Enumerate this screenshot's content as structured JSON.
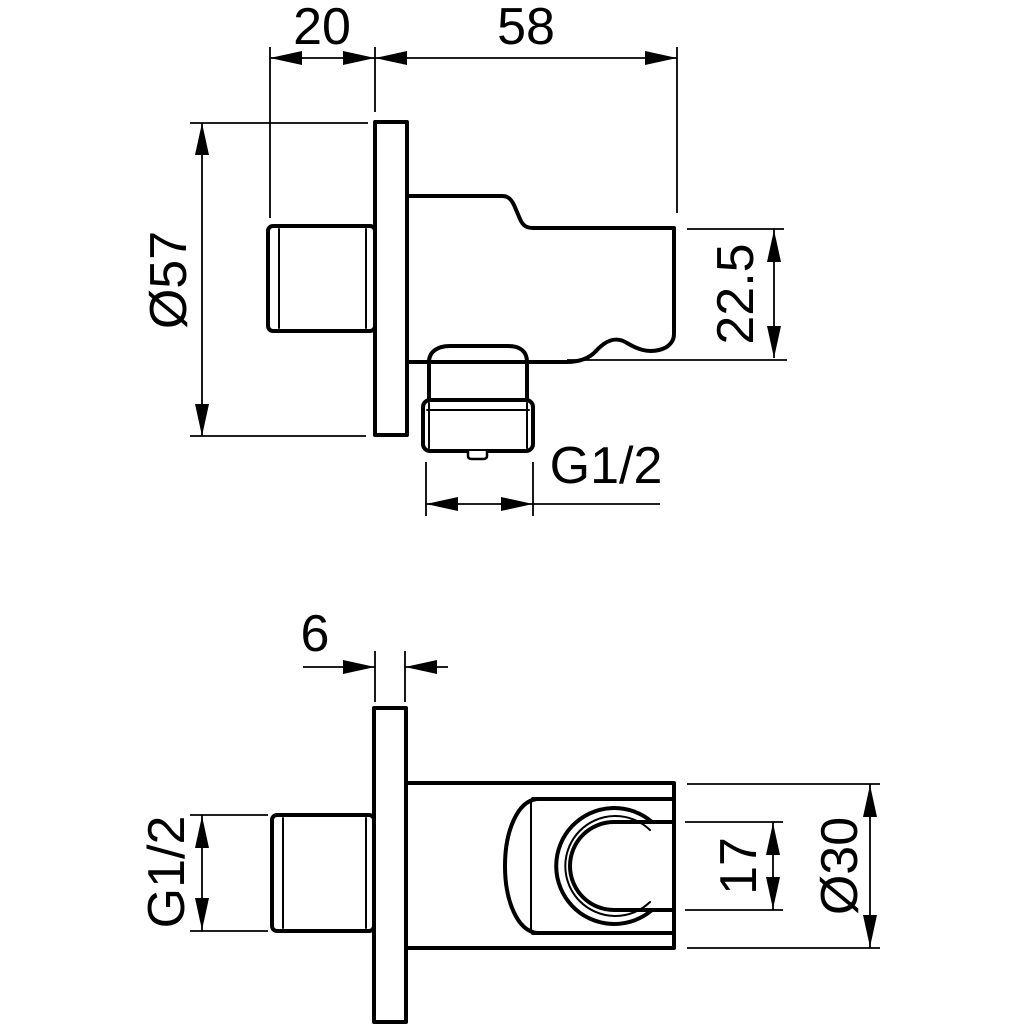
{
  "drawing": {
    "type": "technical-dimension-drawing",
    "subject": "wall-mounted shower handset holder with hose outlet elbow, two orthographic views",
    "colors": {
      "line": "#000000",
      "background": "#ffffff"
    },
    "views": {
      "top": {
        "name": "side-elevation-view"
      },
      "bottom": {
        "name": "plan-view"
      }
    },
    "dimensions": {
      "thread_to_plate": {
        "label": "20"
      },
      "body_depth": {
        "label": "58"
      },
      "plate_diameter": {
        "label": "Ø57"
      },
      "outlet_height": {
        "label": "22.5"
      },
      "outlet_thread": {
        "label": "G1/2"
      },
      "plate_thickness": {
        "label": "6"
      },
      "inlet_thread": {
        "label": "G1/2"
      },
      "cradle_gap": {
        "label": "17"
      },
      "holder_diameter": {
        "label": "Ø30"
      }
    }
  }
}
